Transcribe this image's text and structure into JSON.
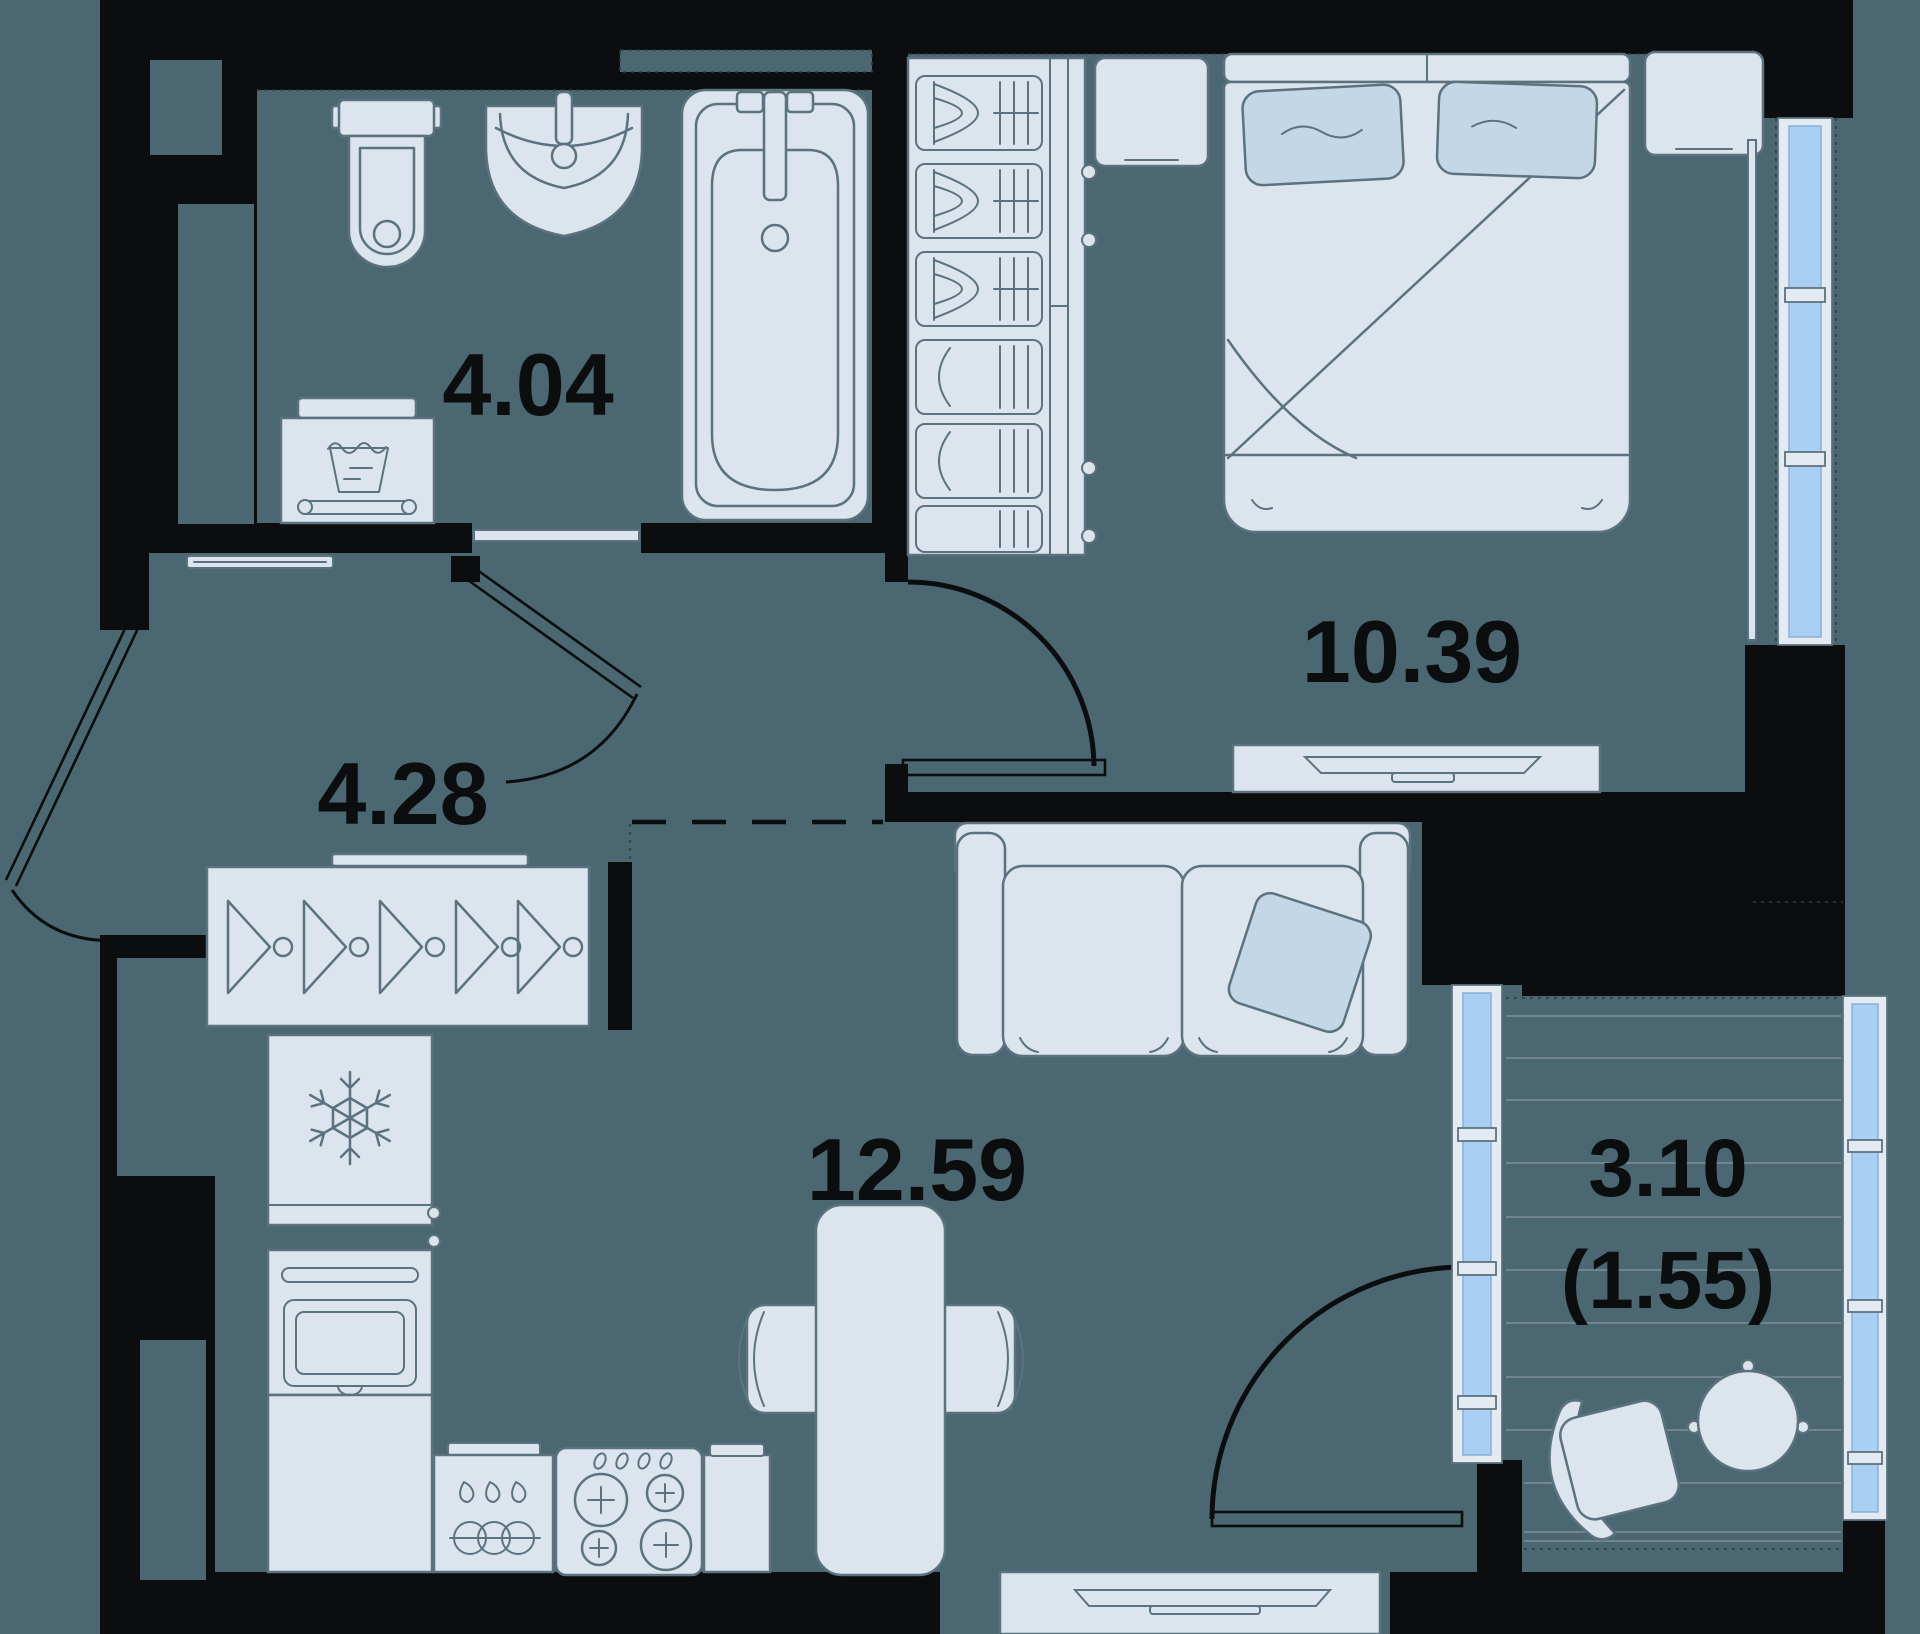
{
  "floor_plan": {
    "type": "floor-plan",
    "colors": {
      "background": "#4B6772",
      "walls": "#0B0D0E",
      "furniture_fill": "#DCE5ED",
      "furniture_stroke": "#5C737F",
      "accent_fill": "#C3D7E7",
      "window_glass": "#A9D0F4",
      "label_text": "#0B0D0E"
    },
    "rooms": [
      {
        "name": "bathroom",
        "area": "4.04",
        "furniture": [
          "toilet",
          "sink",
          "bathtub",
          "washing-machine",
          "shoe-shelf"
        ]
      },
      {
        "name": "hallway",
        "area": "4.28",
        "furniture": [
          "coat-rack-hangers",
          "entry-door"
        ]
      },
      {
        "name": "bedroom",
        "area": "10.39",
        "furniture": [
          "wardrobe",
          "bed",
          "nightstand-left",
          "nightstand-right",
          "tv-dresser",
          "window"
        ]
      },
      {
        "name": "kitchen-living-room",
        "area": "12.59",
        "furniture": [
          "refrigerator",
          "oven",
          "sink-cabinet",
          "stove",
          "dining-table",
          "two-chairs",
          "sofa",
          "tv-console"
        ]
      },
      {
        "name": "balcony",
        "area": "3.10",
        "area_secondary": "(1.55)",
        "furniture": [
          "armchair",
          "round-table",
          "glazing"
        ]
      }
    ]
  }
}
